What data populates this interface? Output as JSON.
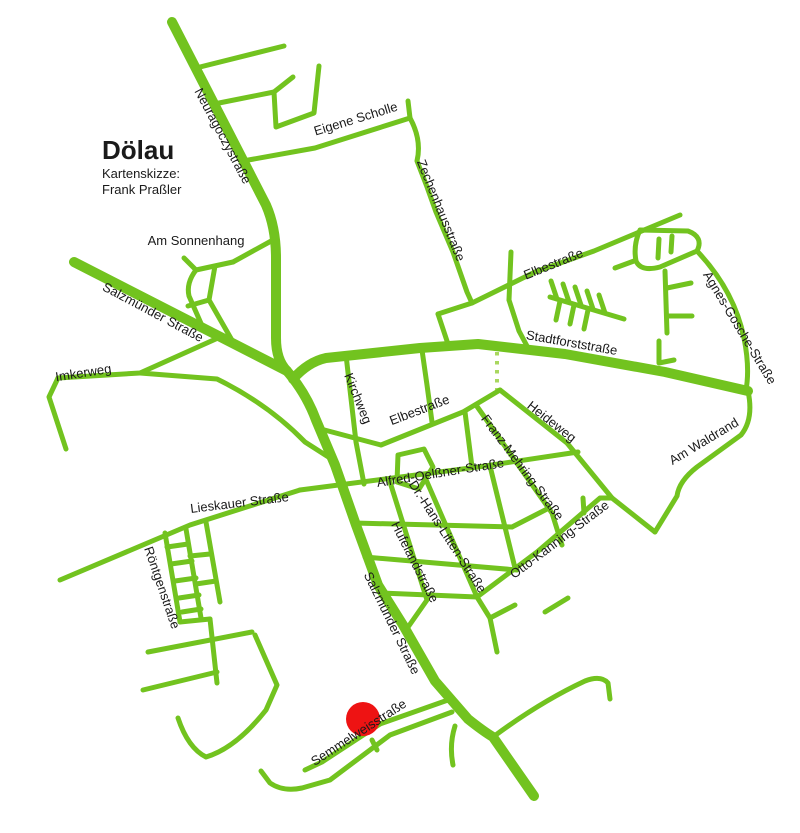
{
  "map": {
    "title": "Dölau",
    "credit_line1": "Kartenskizze:",
    "credit_line2": "Frank Praßler",
    "street_labels": [
      {
        "text": "Neuragoczystraße"
      },
      {
        "text": "Eigene Scholle"
      },
      {
        "text": "Zechenhausstraße"
      },
      {
        "text": "Am Sonnenhang"
      },
      {
        "text": "Elbestraße"
      },
      {
        "text": "Agnes-Gosche-Straße"
      },
      {
        "text": "Stadtforststraße"
      },
      {
        "text": "Salzmünder Straße"
      },
      {
        "text": "Imkerweg"
      },
      {
        "text": "Kirchweg"
      },
      {
        "text": "Elbestraße"
      },
      {
        "text": "Heideweg"
      },
      {
        "text": "Franz-Mehring-Straße"
      },
      {
        "text": "Am Waldrand"
      },
      {
        "text": "Alfred-Oelßner-Straße"
      },
      {
        "text": "Dr.-Hans-Litten-Straße"
      },
      {
        "text": "Otto-Kanning-Straße"
      },
      {
        "text": "Hufelandstraße"
      },
      {
        "text": "Salzmünder Straße"
      },
      {
        "text": "Lieskauer Straße"
      },
      {
        "text": "Röntgenstraße"
      },
      {
        "text": "Semmelweisstraße"
      }
    ],
    "marker": {
      "shape": "circle",
      "color": "#ee1313"
    },
    "colors": {
      "road": "#72c31f",
      "road_dashed": "#a9d75f",
      "text": "#1a1a1a",
      "background": "#ffffff"
    }
  }
}
